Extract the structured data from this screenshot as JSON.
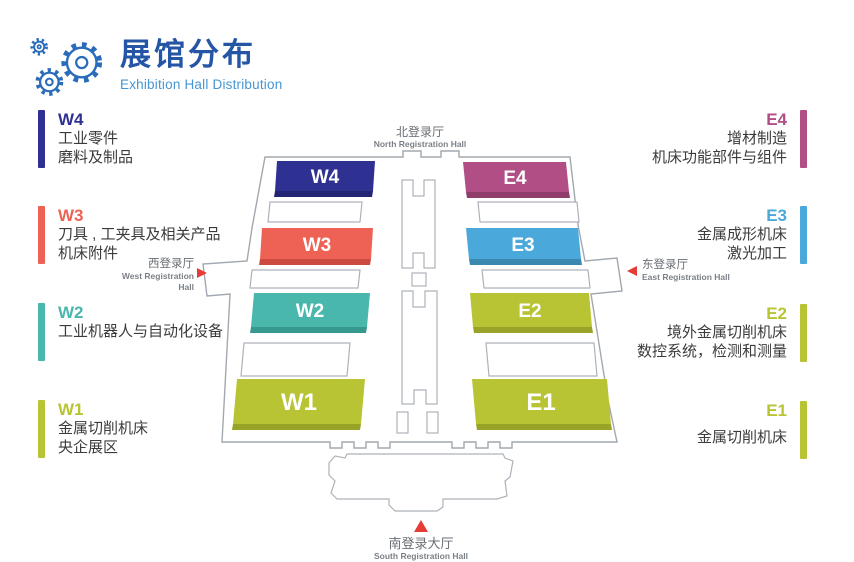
{
  "header": {
    "title": "展馆分布",
    "subtitle": "Exhibition Hall Distribution"
  },
  "colors": {
    "title": "#2456a5",
    "subtitle": "#4596d2",
    "arrow": "#e63c36",
    "outline": "#a2a8af",
    "gear": "#2a6cba"
  },
  "legend_left": [
    {
      "code": "W4",
      "color": "#2e3192",
      "lines": [
        "工业零件",
        "磨料及制品"
      ]
    },
    {
      "code": "W3",
      "color": "#ee6255",
      "lines": [
        "刀具 , 工夹具及相关产品",
        "机床附件"
      ]
    },
    {
      "code": "W2",
      "color": "#4ab7ad",
      "lines": [
        "工业机器人与自动化设备"
      ]
    },
    {
      "code": "W1",
      "color": "#b8c433",
      "lines": [
        "金属切削机床",
        "央企展区"
      ]
    }
  ],
  "legend_right": [
    {
      "code": "E4",
      "color": "#b04e85",
      "lines": [
        "增材制造",
        "机床功能部件与组件"
      ]
    },
    {
      "code": "E3",
      "color": "#4aa9da",
      "lines": [
        "金属成形机床",
        "激光加工"
      ]
    },
    {
      "code": "E2",
      "color": "#b8c433",
      "lines": [
        "境外金属切削机床",
        "数控系统，检测和测量"
      ]
    },
    {
      "code": "E1",
      "color": "#b8c433",
      "lines": [
        "金属切削机床"
      ]
    }
  ],
  "map": {
    "north": {
      "zh": "北登录厅",
      "en": "North Registration Hall"
    },
    "west": {
      "zh": "西登录厅",
      "en": "West Registration Hall"
    },
    "east": {
      "zh": "东登录厅",
      "en": "East Registration Hall"
    },
    "south": {
      "zh": "南登录大厅",
      "en": "South Registration Hall"
    },
    "halls": [
      {
        "id": "W4",
        "label": "W4",
        "color": "#2e3192",
        "shade": "#232472"
      },
      {
        "id": "E4",
        "label": "E4",
        "color": "#b04e85",
        "shade": "#8f3d6b"
      },
      {
        "id": "W3",
        "label": "W3",
        "color": "#ee6255",
        "shade": "#cc4a40"
      },
      {
        "id": "E3",
        "label": "E3",
        "color": "#4aa9da",
        "shade": "#3a87b0"
      },
      {
        "id": "W2",
        "label": "W2",
        "color": "#4ab7ad",
        "shade": "#37988f"
      },
      {
        "id": "E2",
        "label": "E2",
        "color": "#b8c433",
        "shade": "#98a327"
      },
      {
        "id": "W1",
        "label": "W1",
        "color": "#b8c433",
        "shade": "#98a327"
      },
      {
        "id": "E1",
        "label": "E1",
        "color": "#b8c433",
        "shade": "#98a327"
      }
    ],
    "icons": {
      "west_arrow": "triangle-right-icon",
      "east_arrow": "triangle-left-icon",
      "south_arrow": "triangle-up-icon",
      "header": "gears-icon"
    }
  }
}
